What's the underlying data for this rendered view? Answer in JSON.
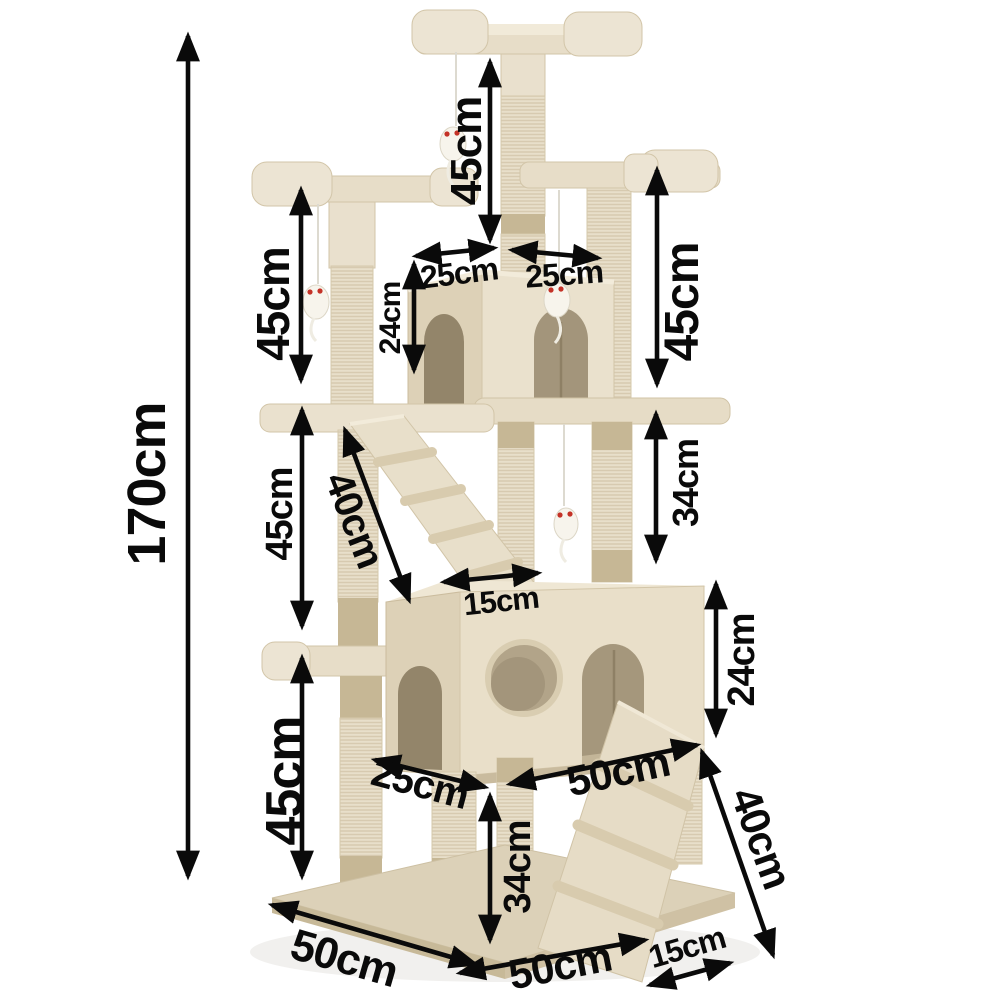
{
  "figure": {
    "subject": "Cat tree scratching post dimension diagram",
    "background_color": "#ffffff",
    "annotation_color": "#0a0a0a",
    "unit": "cm"
  },
  "palette": {
    "plush": "#e9e0cd",
    "plush_light": "#f1ead9",
    "plush_dark": "#ddd1b7",
    "sisal": "#e8dfca",
    "sisal_band": "#c6b795",
    "condo_interior": "#a3957b",
    "condo_interior_dark": "#8e8065",
    "base_top": "#dcd1b8",
    "toy_body": "#f7f4ec",
    "toy_eye": "#c43227"
  },
  "dimensions": {
    "total_height": {
      "label": "170cm"
    },
    "top_post_height": {
      "label": "45cm"
    },
    "upper_left_post_height": {
      "label": "45cm"
    },
    "upper_right_post_height": {
      "label": "45cm"
    },
    "top_platform_left_width": {
      "label": "25cm"
    },
    "top_platform_right_width": {
      "label": "25cm"
    },
    "small_condo_height": {
      "label": "24cm"
    },
    "middle_left_post_height": {
      "label": "45cm"
    },
    "upper_ramp_length": {
      "label": "40cm"
    },
    "middle_right_post_height": {
      "label": "34cm"
    },
    "upper_ramp_width": {
      "label": "15cm"
    },
    "large_condo_height": {
      "label": "24cm"
    },
    "lower_left_post_height": {
      "label": "45cm"
    },
    "large_condo_depth": {
      "label": "25cm"
    },
    "large_condo_width": {
      "label": "50cm"
    },
    "lower_ramp_length": {
      "label": "40cm"
    },
    "lower_post_height": {
      "label": "34cm"
    },
    "base_depth": {
      "label": "50cm"
    },
    "base_width": {
      "label": "50cm"
    },
    "lower_ramp_width": {
      "label": "15cm"
    }
  }
}
